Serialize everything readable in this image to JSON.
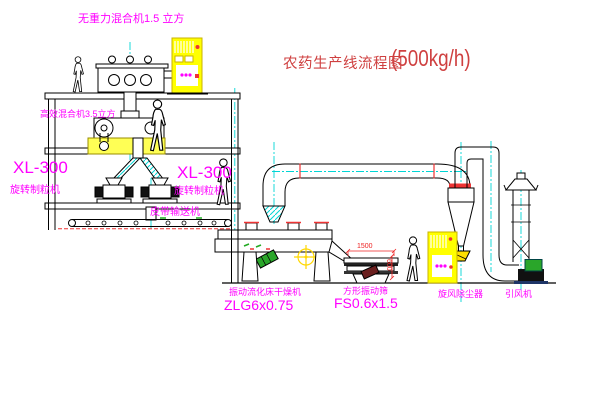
{
  "title": {
    "text": "农药生产线流程图",
    "capacity": "(500kg/h)"
  },
  "equipment_labels": {
    "gravity_free_mixer": "无重力混合机1.5 立方",
    "high_efficiency_mixer": "高效混合机3.5立方",
    "granulator_left": {
      "model": "XL-300",
      "name": "旋转制粒机"
    },
    "granulator_right": {
      "model": "XL-300",
      "name": "旋转制粒机"
    },
    "belt_conveyor": "皮带输送机",
    "fluid_bed_dryer": {
      "name": "振动流化床干燥机",
      "model": "ZLG6x0.75"
    },
    "vibrating_screen": {
      "name": "方形振动筛",
      "model": "FS0.6x1.5"
    },
    "cyclone_dust_collector": "旋风除尘器",
    "induced_draft_fan": "引风机"
  },
  "dimensions": {
    "screen_length": "1500",
    "screen_height": "600"
  },
  "colors": {
    "label_magenta": "#ff00ff",
    "title_red": "#cf4040",
    "dimension_red": "#ee2222",
    "centerline_cyan": "#00d5d5",
    "cabinet_yellow": "#ffff00",
    "motor_green": "#2aa62a"
  }
}
